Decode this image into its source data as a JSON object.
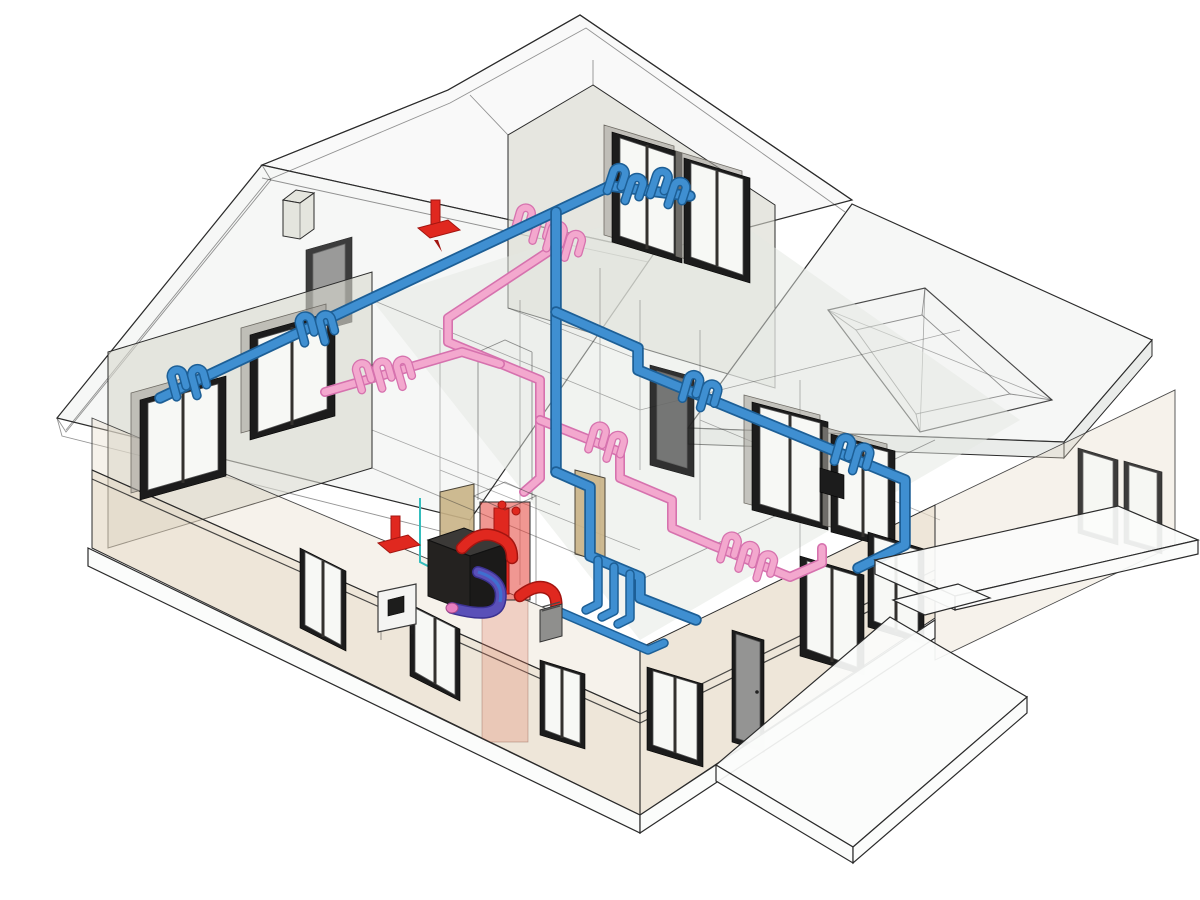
{
  "scene": {
    "kind": "isometric-bim-cutaway",
    "subject": "two-storey residential house with exposed plumbing systems",
    "background": "#ffffff",
    "has_text": false
  },
  "colors": {
    "bg": "#ffffff",
    "outline": "#2b2b2b",
    "roof-fill": "#eef0ee",
    "roof-band": "#dcdfdc",
    "wall-beige": "#e3d6c1",
    "wall-grey": "#d9d8cf",
    "interior-fill": "#e3e7e1",
    "glass": "#f7f8f5",
    "frame-dark": "#1c1c1c",
    "door-tan": "#c9b286",
    "slab-white": "#fbfcfb",
    "pipe-cold": "#3f8fd1",
    "pipe-cold-dark": "#1d5f96",
    "pipe-hot": "#f3a8ce",
    "pipe-hot-dark": "#d672ae",
    "vent-red": "#e0281f",
    "vent-red-dark": "#a31510",
    "duct-purple": "#5a50b8",
    "duct-purple-dark": "#3b3190",
    "duct-blue": "#3f6fd0",
    "condensate-teal": "#35bdbd",
    "equipment-black": "#242220",
    "equipment-black-top": "#3b3937",
    "equipment-grey": "#8f8f8d",
    "equipment-white": "#f4f4f2",
    "chase-red-fill": "rgba(226,48,38,0.5)",
    "chase-red-faded": "rgba(228,122,96,0.28)"
  },
  "systems": [
    {
      "id": "cold-water-piping",
      "color": "#3f8fd1",
      "loop_clusters": 6
    },
    {
      "id": "hot-water-piping",
      "color": "#f3a8ce",
      "loop_clusters": 4
    },
    {
      "id": "flue-vent-piping",
      "color": "#e0281f",
      "roof_vents": 2
    },
    {
      "id": "equipment-duct",
      "color": "#5a50b8"
    },
    {
      "id": "condensate-line",
      "color": "#35bdbd"
    }
  ],
  "building": {
    "storeys": 2,
    "windows_visible": 16,
    "doors_visible": 3,
    "dormers": 2,
    "chimney_boxes": 1,
    "deck_slabs": 2,
    "equipment": [
      "furnace",
      "water-heater",
      "exterior-vent-unit",
      "red-pipe-chase"
    ]
  }
}
